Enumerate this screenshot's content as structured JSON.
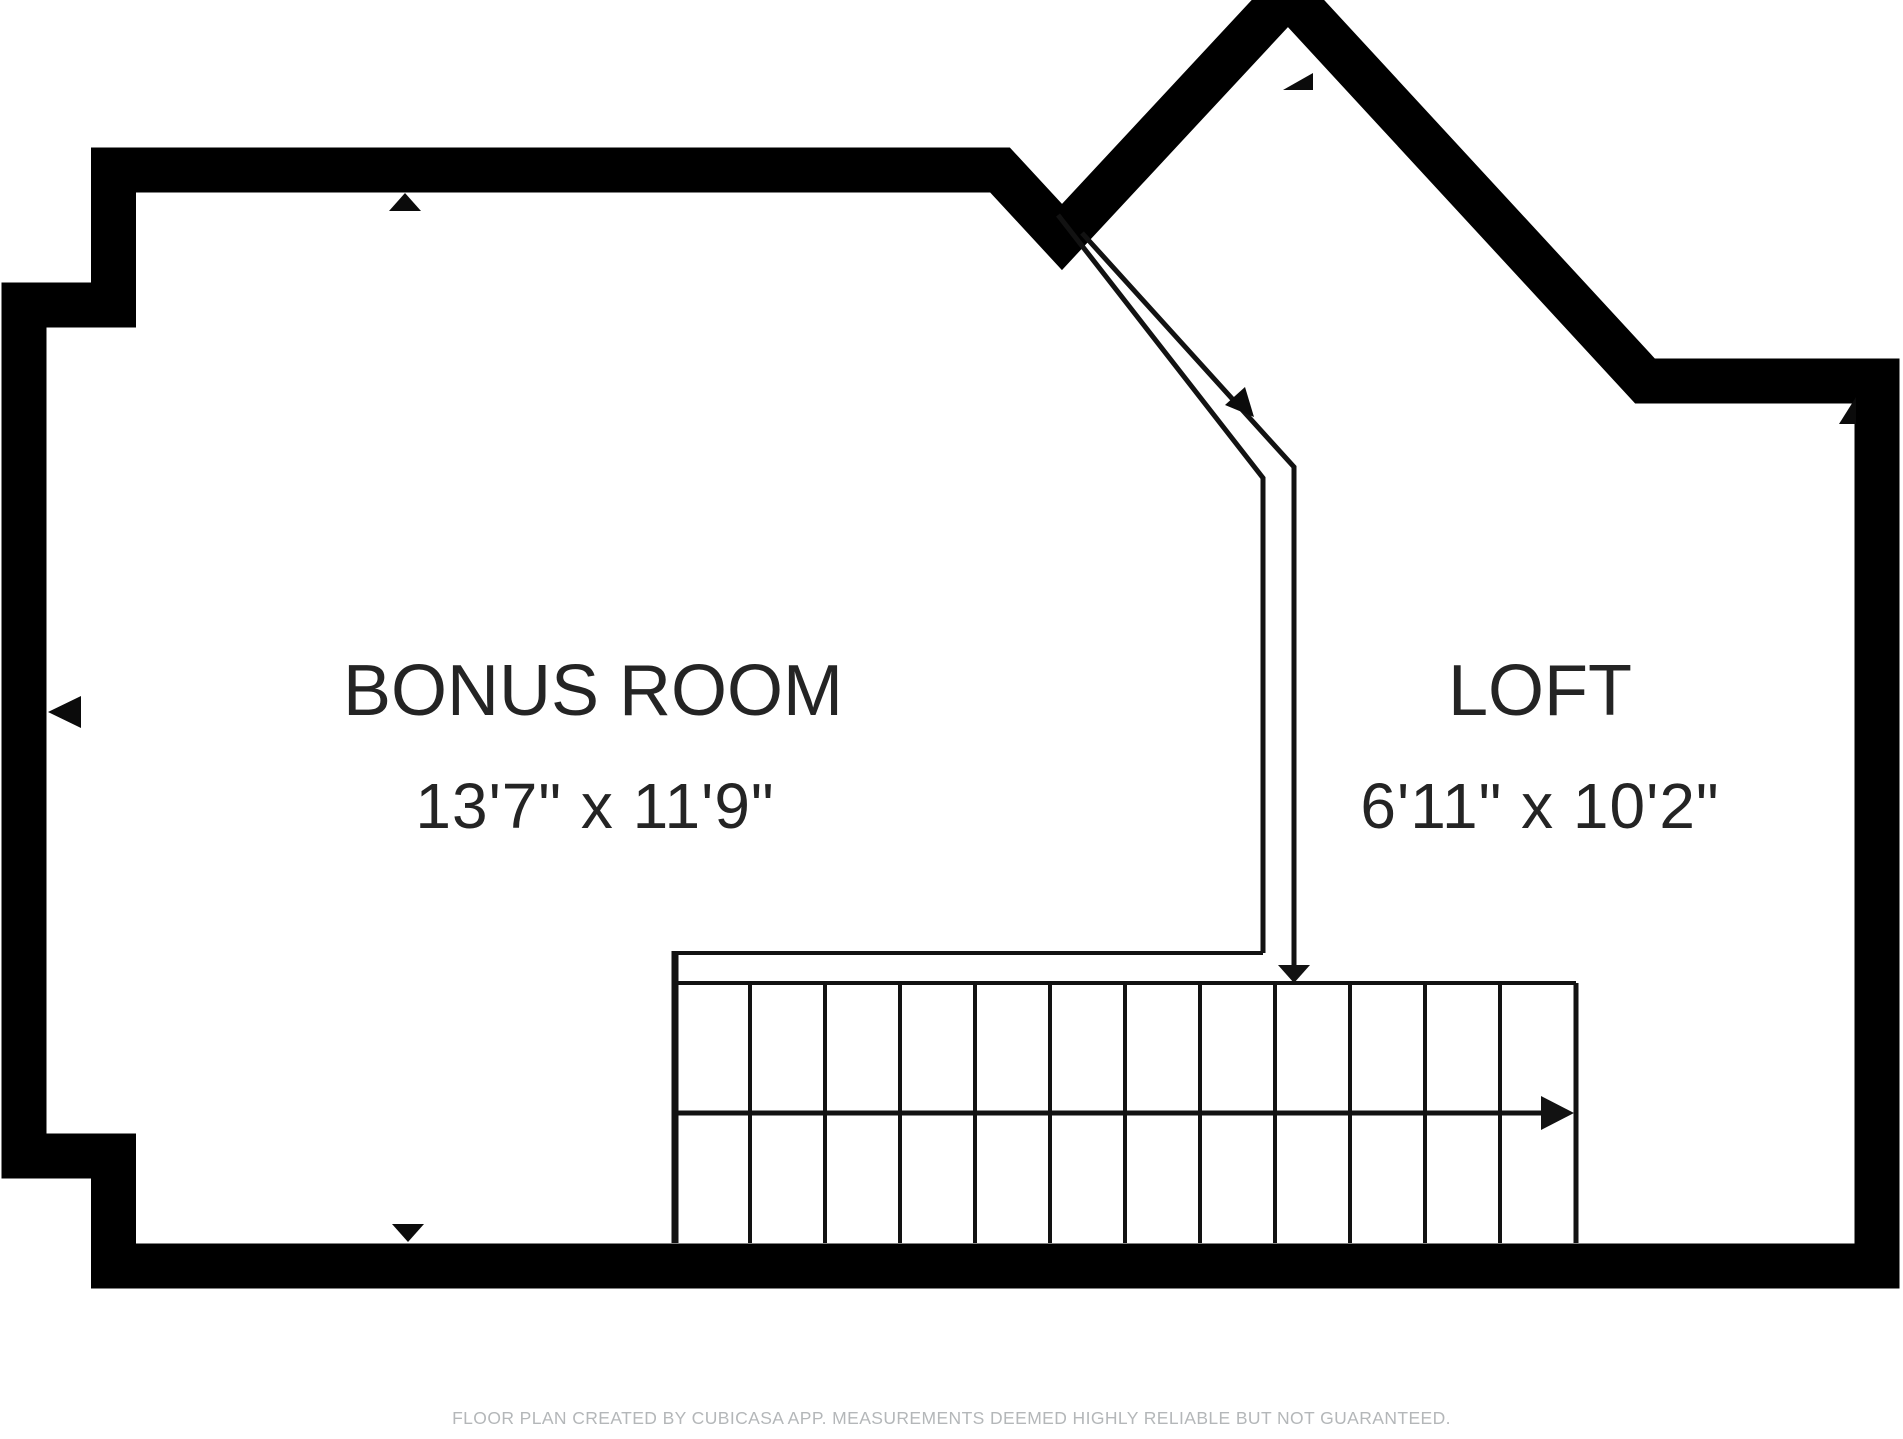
{
  "canvas": {
    "width": 1903,
    "height": 1439,
    "background": "#ffffff",
    "wall_color": "#000000",
    "line_color": "#121212",
    "text_color": "#242424"
  },
  "rooms": [
    {
      "name": "BONUS ROOM",
      "dimensions": "13'7\" x 11'9\""
    },
    {
      "name": "LOFT",
      "dimensions": "6'11\" x 10'2\""
    }
  ],
  "footer": {
    "text": "FLOOR PLAN CREATED BY CUBICASA APP. MEASUREMENTS DEEMED HIGHLY RELIABLE BUT NOT GUARANTEED.",
    "color": "#b4b7b9"
  },
  "geometry": {
    "wall_path": "M 24 305 H 113.5 V 170 H 1000 L 1062 237 L 1288 -6 L 1645 381 H 1877 V 1266 H 113.5 V 1156 H 24 Z",
    "wall_stroke_width": 45,
    "stairs": {
      "left": 675,
      "right": 1576,
      "strip_top": 953,
      "cells_top": 983,
      "mid": 1113,
      "bottom": 1243,
      "landing_right": 1263,
      "upper_dividers": [
        750,
        825,
        900,
        975,
        1050,
        1125,
        1200,
        1275,
        1350,
        1425,
        1500
      ],
      "lower_dividers": [
        750,
        825,
        900,
        975,
        1050,
        1125,
        1200,
        1275,
        1350,
        1425,
        1500
      ]
    },
    "railing_outer_points": "1058,215 1263,478 1263,953",
    "railing_inner_points": "1082,233 1294,467 1294,966",
    "down_arrow_head": "1294,983 1278,965 1310,965",
    "stair_arrow_shaft": {
      "x1": 677,
      "y1": 1113,
      "x2": 1545,
      "y2": 1113
    },
    "stair_arrow_head": "1574,1113 1541,1096 1541,1130",
    "opening_markers": [
      {
        "id": "marker-top-wall",
        "points": "405,193 389,211 421,211"
      },
      {
        "id": "marker-left-wall",
        "points": "48,712 81,696 81,728"
      },
      {
        "id": "marker-bottom-wall",
        "points": "408,1242 392,1224 424,1224"
      },
      {
        "id": "marker-peak",
        "points": "1283,90 1313,90 1313,73"
      },
      {
        "id": "marker-railing",
        "points": "1254,417 1225,405 1245,387"
      },
      {
        "id": "marker-right-corner",
        "points": "1839,424 1856,397 1856,424"
      }
    ]
  }
}
